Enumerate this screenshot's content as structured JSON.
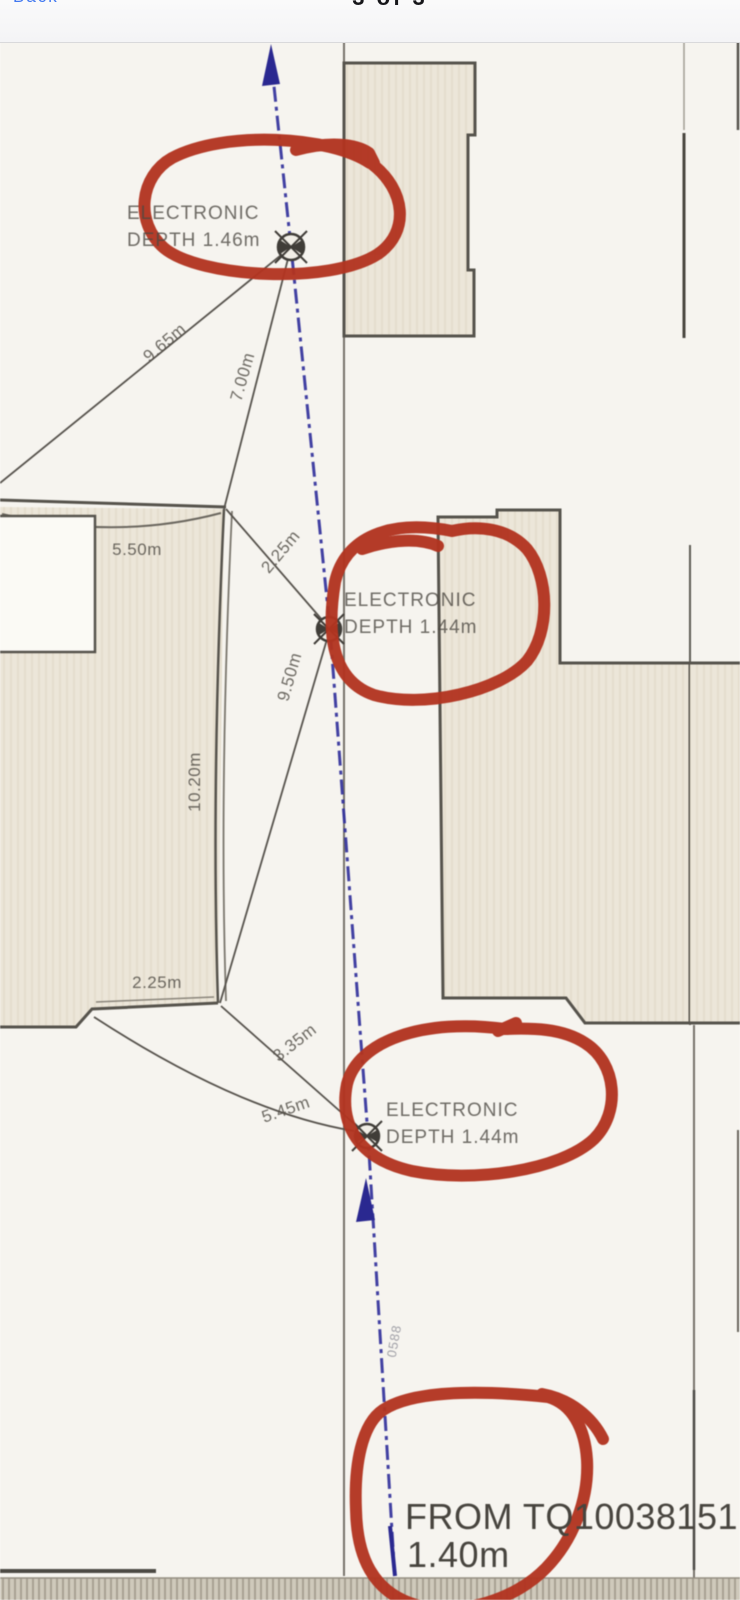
{
  "header": {
    "back_fragment": "Back",
    "pager": "3 of 3"
  },
  "map": {
    "survey_points": [
      {
        "line1": "ELECTRONIC",
        "line2": "DEPTH 1.46m"
      },
      {
        "line1": "ELECTRONIC",
        "line2": "DEPTH 1.44m"
      },
      {
        "line1": "ELECTRONIC",
        "line2": "DEPTH 1.44m"
      }
    ],
    "dimensions": [
      "9.65m",
      "7.00m",
      "5.50m",
      "2.25m",
      "9.50m",
      "10.20m",
      "2.25m",
      "3.35m",
      "5.45m"
    ],
    "cable_code": "0588",
    "from_reference": "FROM TQ10038151",
    "from_depth": "1.40m",
    "colors": {
      "annotation_red": "#b23420",
      "cable_blue": "#31309b",
      "building_fill": "#ece6d9",
      "paper": "#f6f4ef"
    }
  }
}
